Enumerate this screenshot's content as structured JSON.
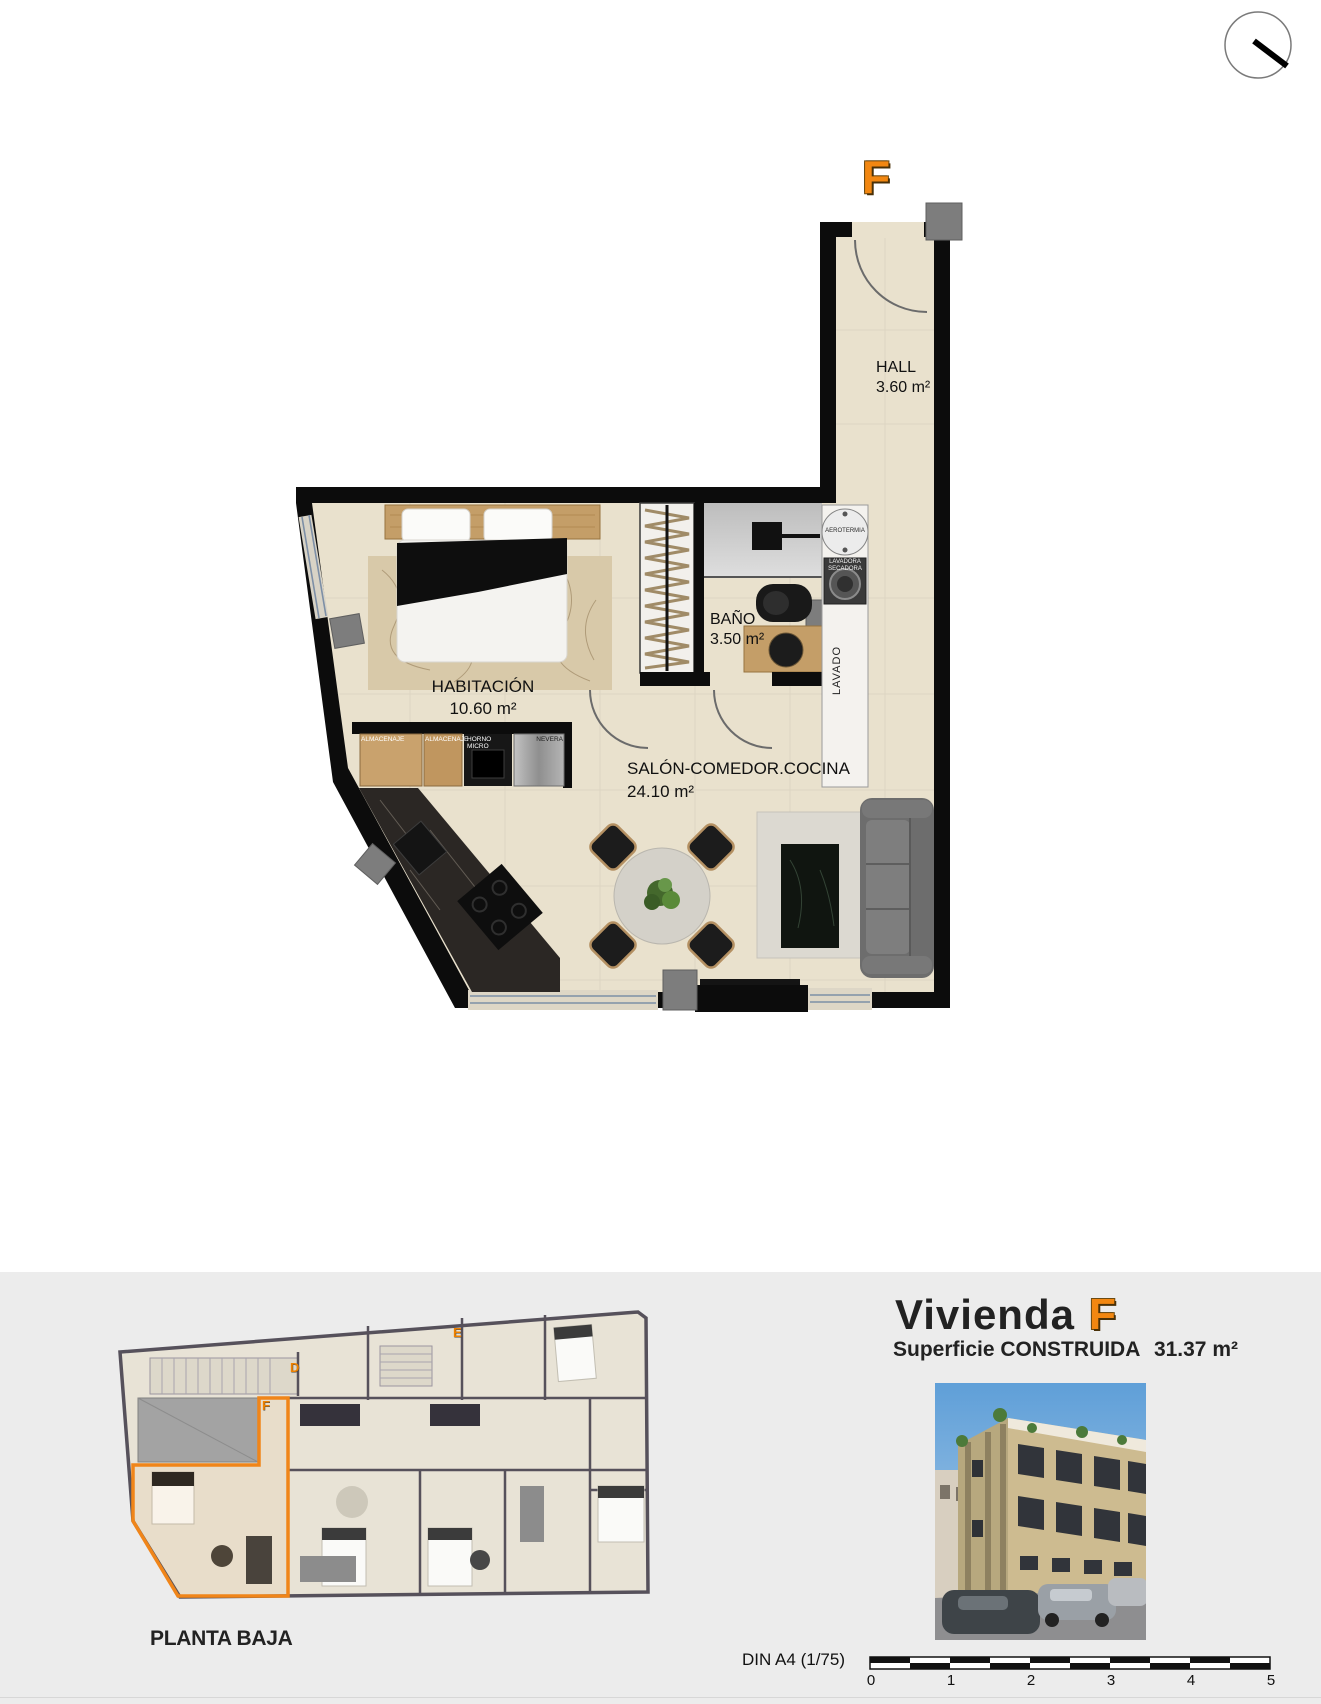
{
  "page": {
    "background": "#ffffff",
    "footer_background": "#ececec"
  },
  "colors": {
    "accent_orange": "#f28711",
    "wall_black": "#0c0c0c",
    "floor_beige": "#e9e1cd",
    "wood": "#c49e68"
  },
  "plan": {
    "unit_letter": "F",
    "rooms": {
      "hall": {
        "label": "HALL",
        "area": "3.60 m²"
      },
      "bano": {
        "label": "BAÑO",
        "area": "3.50 m²"
      },
      "habitacion": {
        "label": "HABITACIÓN",
        "area": "10.60 m²"
      },
      "salon": {
        "label": "SALÓN-COMEDOR.COCINA",
        "area": "24.10 m²"
      }
    },
    "fixtures": {
      "aerotermia": "AEROTERMIA",
      "washer_line1": "LAVADORA",
      "washer_line2": "SECADORA",
      "lavado": "LAVADO",
      "cab1": "ALMACENAJE",
      "cab2": "ALMACENAJE",
      "oven_line1": "HORNO",
      "oven_line2": "MICRO",
      "fridge": "NEVERA"
    }
  },
  "footer": {
    "site_caption": "PLANTA BAJA",
    "unit_title": "Vivienda",
    "unit_letter": "F",
    "area_label": "Superficie CONSTRUIDA",
    "area_value": "31.37 m²",
    "scale_label": "DIN A4 (1/75)",
    "scale_ticks": [
      "0",
      "1",
      "2",
      "3",
      "4",
      "5"
    ],
    "site_letters": {
      "d": "D",
      "e": "E",
      "f": "F"
    }
  }
}
